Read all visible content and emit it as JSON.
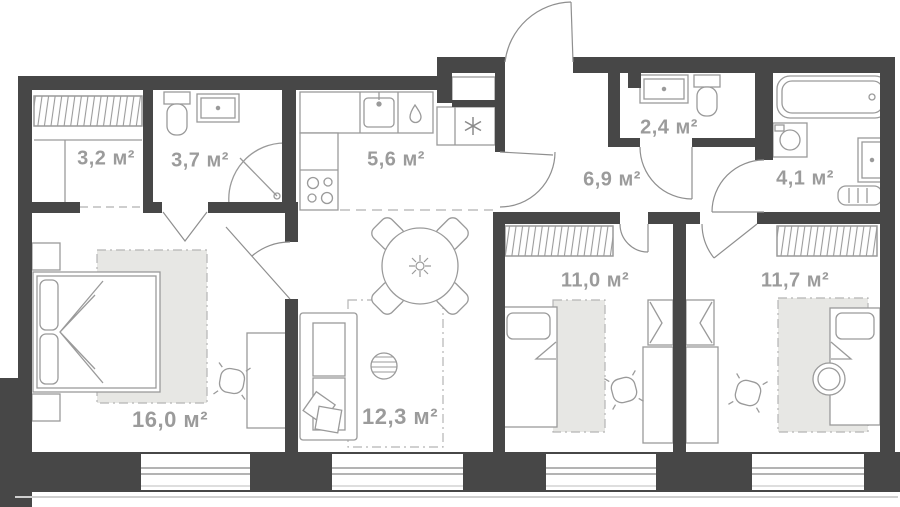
{
  "floor_plan": {
    "unit": "м²",
    "rooms": [
      {
        "id": "wardrobe",
        "area_label": "3,2 м²"
      },
      {
        "id": "bathroom-small",
        "area_label": "3,7 м²"
      },
      {
        "id": "kitchen",
        "area_label": "5,6 м²"
      },
      {
        "id": "wc",
        "area_label": "2,4 м²"
      },
      {
        "id": "hallway",
        "area_label": "6,9 м²"
      },
      {
        "id": "bathroom",
        "area_label": "4,1 м²"
      },
      {
        "id": "bedroom-2",
        "area_label": "11,0 м²"
      },
      {
        "id": "bedroom-3",
        "area_label": "11,7 м²"
      },
      {
        "id": "bedroom-main",
        "area_label": "16,0 м²"
      },
      {
        "id": "living-room",
        "area_label": "12,3 м²"
      }
    ],
    "icons": {
      "fridge": "snowflake-asterisk",
      "kitchen_water": "water-drop",
      "kitchen_sink": "faucet-basin",
      "dining_table": "flower-rosette",
      "shower": "quarter-circle-with-drain",
      "wardrobe_rail": "hanger-hatching"
    },
    "colors": {
      "wall": "#474747",
      "label": "#9b9b9b",
      "line": "#9a9a9a",
      "rug_fill": "#e7e7e4",
      "dash": "#b5b5b5"
    }
  }
}
